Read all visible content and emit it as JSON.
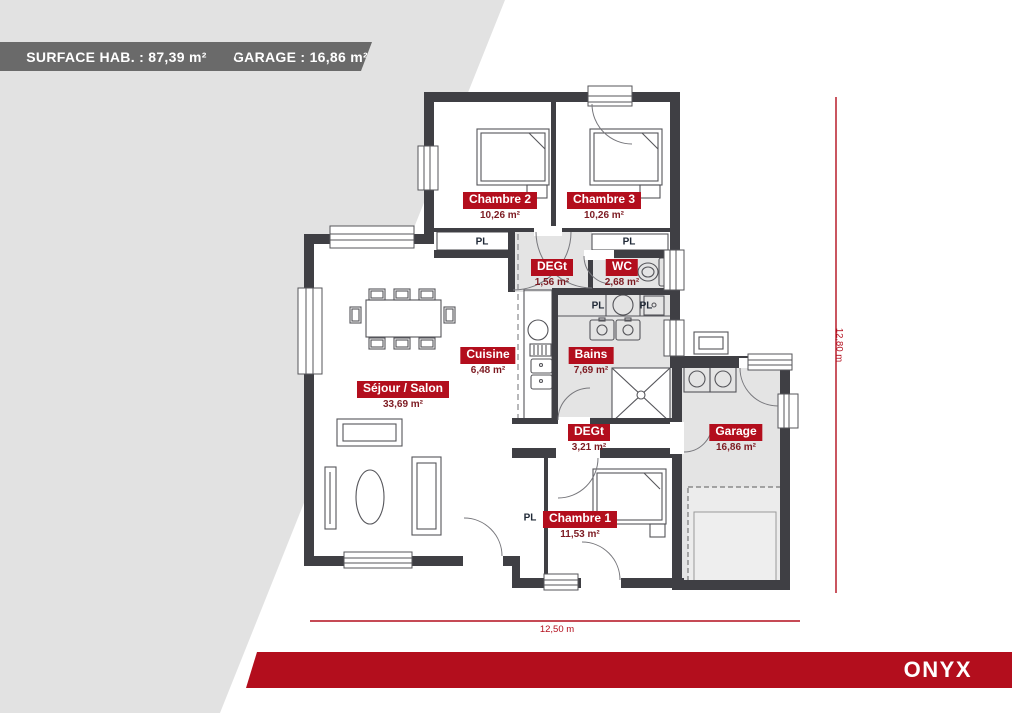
{
  "header": {
    "surface_label": "SURFACE HAB. : 87,39 m²",
    "garage_label": "GARAGE : 16,86 m²"
  },
  "floorplan": {
    "rooms": [
      {
        "id": "chambre-2",
        "name": "Chambre 2",
        "area": "10,26 m²",
        "x": 500,
        "y": 192
      },
      {
        "id": "chambre-3",
        "name": "Chambre 3",
        "area": "10,26 m²",
        "x": 604,
        "y": 192
      },
      {
        "id": "degagement-1",
        "name": "DEGt",
        "area": "1,56 m²",
        "x": 552,
        "y": 259
      },
      {
        "id": "wc",
        "name": "WC",
        "area": "2,68 m²",
        "x": 622,
        "y": 259
      },
      {
        "id": "cuisine",
        "name": "Cuisine",
        "area": "6,48 m²",
        "x": 488,
        "y": 347
      },
      {
        "id": "bains",
        "name": "Bains",
        "area": "7,69 m²",
        "x": 591,
        "y": 347
      },
      {
        "id": "sejour-salon",
        "name": "Séjour / Salon",
        "area": "33,69 m²",
        "x": 403,
        "y": 381
      },
      {
        "id": "degagement-2",
        "name": "DEGt",
        "area": "3,21 m²",
        "x": 589,
        "y": 424
      },
      {
        "id": "garage",
        "name": "Garage",
        "area": "16,86 m²",
        "x": 736,
        "y": 424
      },
      {
        "id": "chambre-1",
        "name": "Chambre 1",
        "area": "11,53 m²",
        "x": 580,
        "y": 511
      }
    ],
    "closets": [
      {
        "label": "PL",
        "x": 482,
        "y": 242
      },
      {
        "label": "PL",
        "x": 629,
        "y": 242
      },
      {
        "label": "PL",
        "x": 598,
        "y": 306
      },
      {
        "label": "PL",
        "x": 646,
        "y": 306
      },
      {
        "label": "PL",
        "x": 530,
        "y": 518
      }
    ],
    "dimensions": {
      "width": "12,50 m",
      "height": "12,80 m"
    }
  },
  "footer": {
    "model_name": "ONYX"
  },
  "colors": {
    "accent_red": "#b30e1d",
    "banner_gray": "#6a6a6a",
    "wall": "#3f3f44",
    "room_fill": "#e4e4e4",
    "background_gray": "#e2e2e2",
    "area_text": "#7d1b22",
    "closet_text": "#1f2836"
  }
}
